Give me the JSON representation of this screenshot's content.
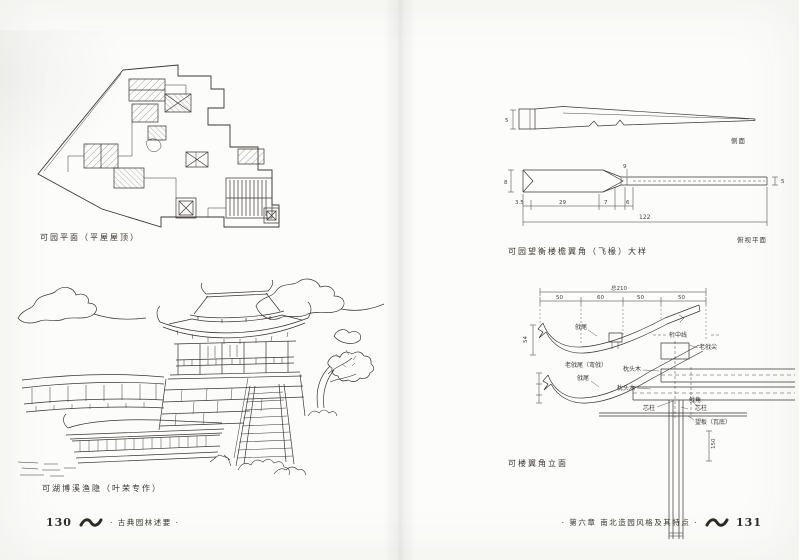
{
  "colors": {
    "paper": "#fcfcfa",
    "ink": "#3b3733"
  },
  "left_page": {
    "plan_caption": "可园平面（平屋屋顶）",
    "scene_caption": "可湖博溪渔隐（叶荣专作）",
    "footer_page_number": "130",
    "footer_book_title": "· 古典园林述要 ·"
  },
  "right_page": {
    "detail_caption": "可园望衡楼檐翼角（飞椽）大样",
    "elevation_caption": "可楼翼角立面",
    "footer_chapter_title": "· 第六章 南北造园风格及其特点 ·",
    "footer_page_number": "131",
    "side_view": {
      "label": "侧面",
      "dim_height": "5"
    },
    "plan_view": {
      "label": "俯视平面",
      "dim_a": "3.5",
      "dim_b": "29",
      "dim_c": "7",
      "dim_d": "6",
      "dim_total": "122",
      "dim_left": "8",
      "dim_right": "5",
      "dim_neck": "9"
    },
    "elevation": {
      "dim_total": "总210",
      "seg_a": "50",
      "seg_b": "60",
      "seg_c": "50",
      "seg_d": "50",
      "dim_left": "54",
      "dim_column": "150",
      "sub_caption": "老戗尾（弯戗）",
      "label_tail_top": "戗尾",
      "label_tail_bottom": "戗尾",
      "label_centerline": "桁中线",
      "label_tip": "老戗尖",
      "label_pillow_a": "枕头木",
      "label_pillow_b": "枕头木",
      "label_core_a": "芯柱",
      "label_core_b": "芯柱",
      "label_corner": "戗角",
      "label_board": "望板（瓦底）"
    }
  }
}
